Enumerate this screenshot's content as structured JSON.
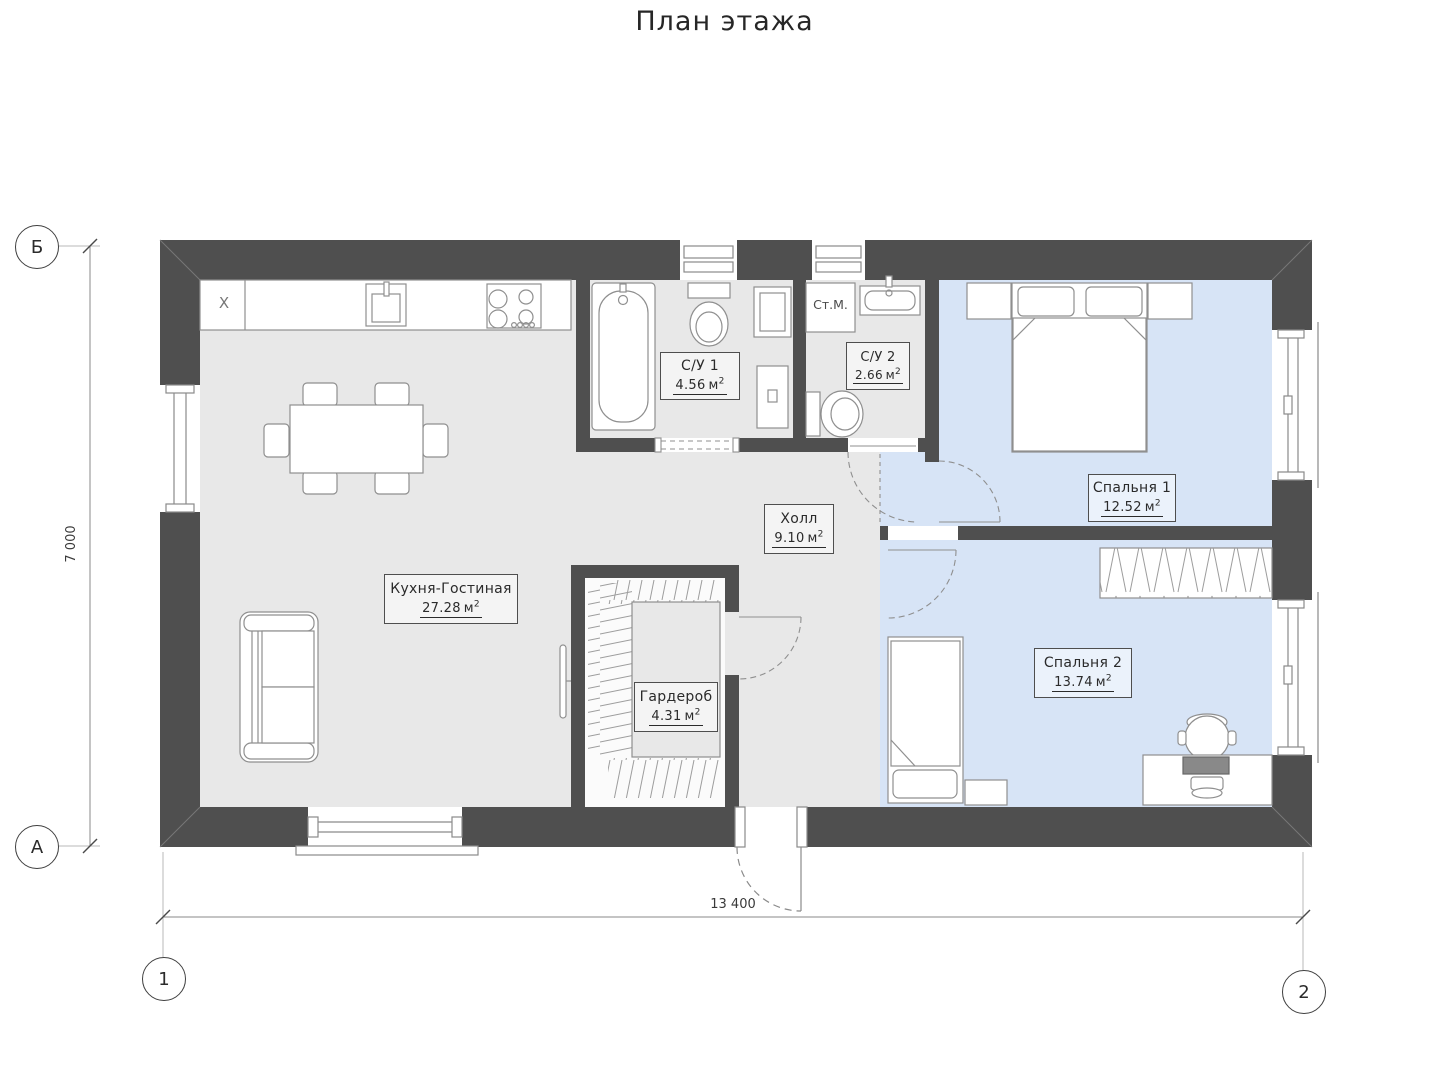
{
  "title": "План этажа",
  "rooms": [
    {
      "name": "Кухня-Гостиная",
      "area": "27.28"
    },
    {
      "name": "С/У 1",
      "area": "4.56"
    },
    {
      "name": "С/У 2",
      "area": "2.66"
    },
    {
      "name": "Спальня 1",
      "area": "12.52"
    },
    {
      "name": "Холл",
      "area": "9.10"
    },
    {
      "name": "Гардероб",
      "area": "4.31"
    },
    {
      "name": "Спальня 2",
      "area": "13.74"
    }
  ],
  "units": {
    "m": "м",
    "sup": "2"
  },
  "misc": {
    "washing_machine": "Ст.М.",
    "kitchen_unit": "X"
  },
  "grid": {
    "b": "Б",
    "a": "А",
    "c1": "1",
    "c2": "2"
  },
  "dims": {
    "width": "13 400",
    "height": "7 000"
  },
  "colors": {
    "wall": "#4f4f4f",
    "floor": "#e8e8e8",
    "floor_blue": "#d7e4f6",
    "line": "#8f8f8f",
    "ink": "#2e2e2e"
  }
}
